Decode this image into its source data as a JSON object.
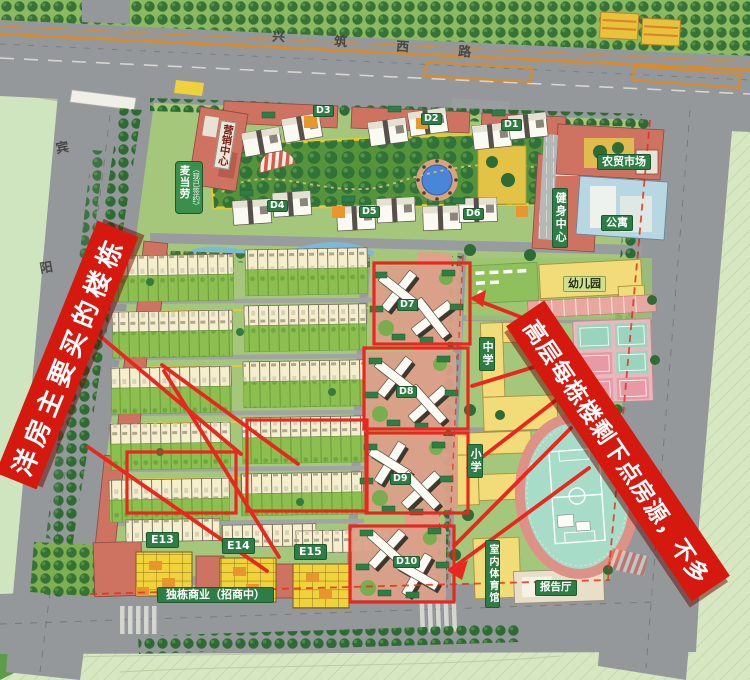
{
  "annotations": {
    "left_banner": "洋房主要买的楼栋",
    "right_banner": "高层每栋楼剩下点房源，不多"
  },
  "roads": {
    "top_chars": [
      "兴",
      "筑",
      "西",
      "路"
    ],
    "left_chars": [
      "宾",
      "阳"
    ]
  },
  "signs": {
    "marketing": "营销中心",
    "signed": "（现已签约）",
    "tenant": "麦当劳"
  },
  "facilities": {
    "market": "农贸市场",
    "fitness": "健身中心",
    "apartment": "公寓",
    "kindergarten": "幼儿园",
    "middle_school": "中学",
    "primary_school": "小学",
    "indoor_gym": "室内体育馆",
    "lecture_hall": "报告厅",
    "street_commercial": "独栋商业（招商中）"
  },
  "buildings": {
    "d1": "D1",
    "d2": "D2",
    "d3": "D3",
    "d4": "D4",
    "d5": "D5",
    "d6": "D6",
    "d7": "D7",
    "d8": "D8",
    "d9": "D9",
    "d10": "D10",
    "e13": "E13",
    "e14": "E14",
    "e15": "E15"
  },
  "colors": {
    "annotation_red": "#d6190e",
    "road_gray": "#94989a",
    "site_green": "#a5c77b",
    "building_salmon": "#ce7262",
    "school_yellow": "#f2dc7a",
    "pool_blue": "#4a86d8",
    "badge_green": "#2e7d46",
    "accent_orange": "#e08a1f"
  }
}
